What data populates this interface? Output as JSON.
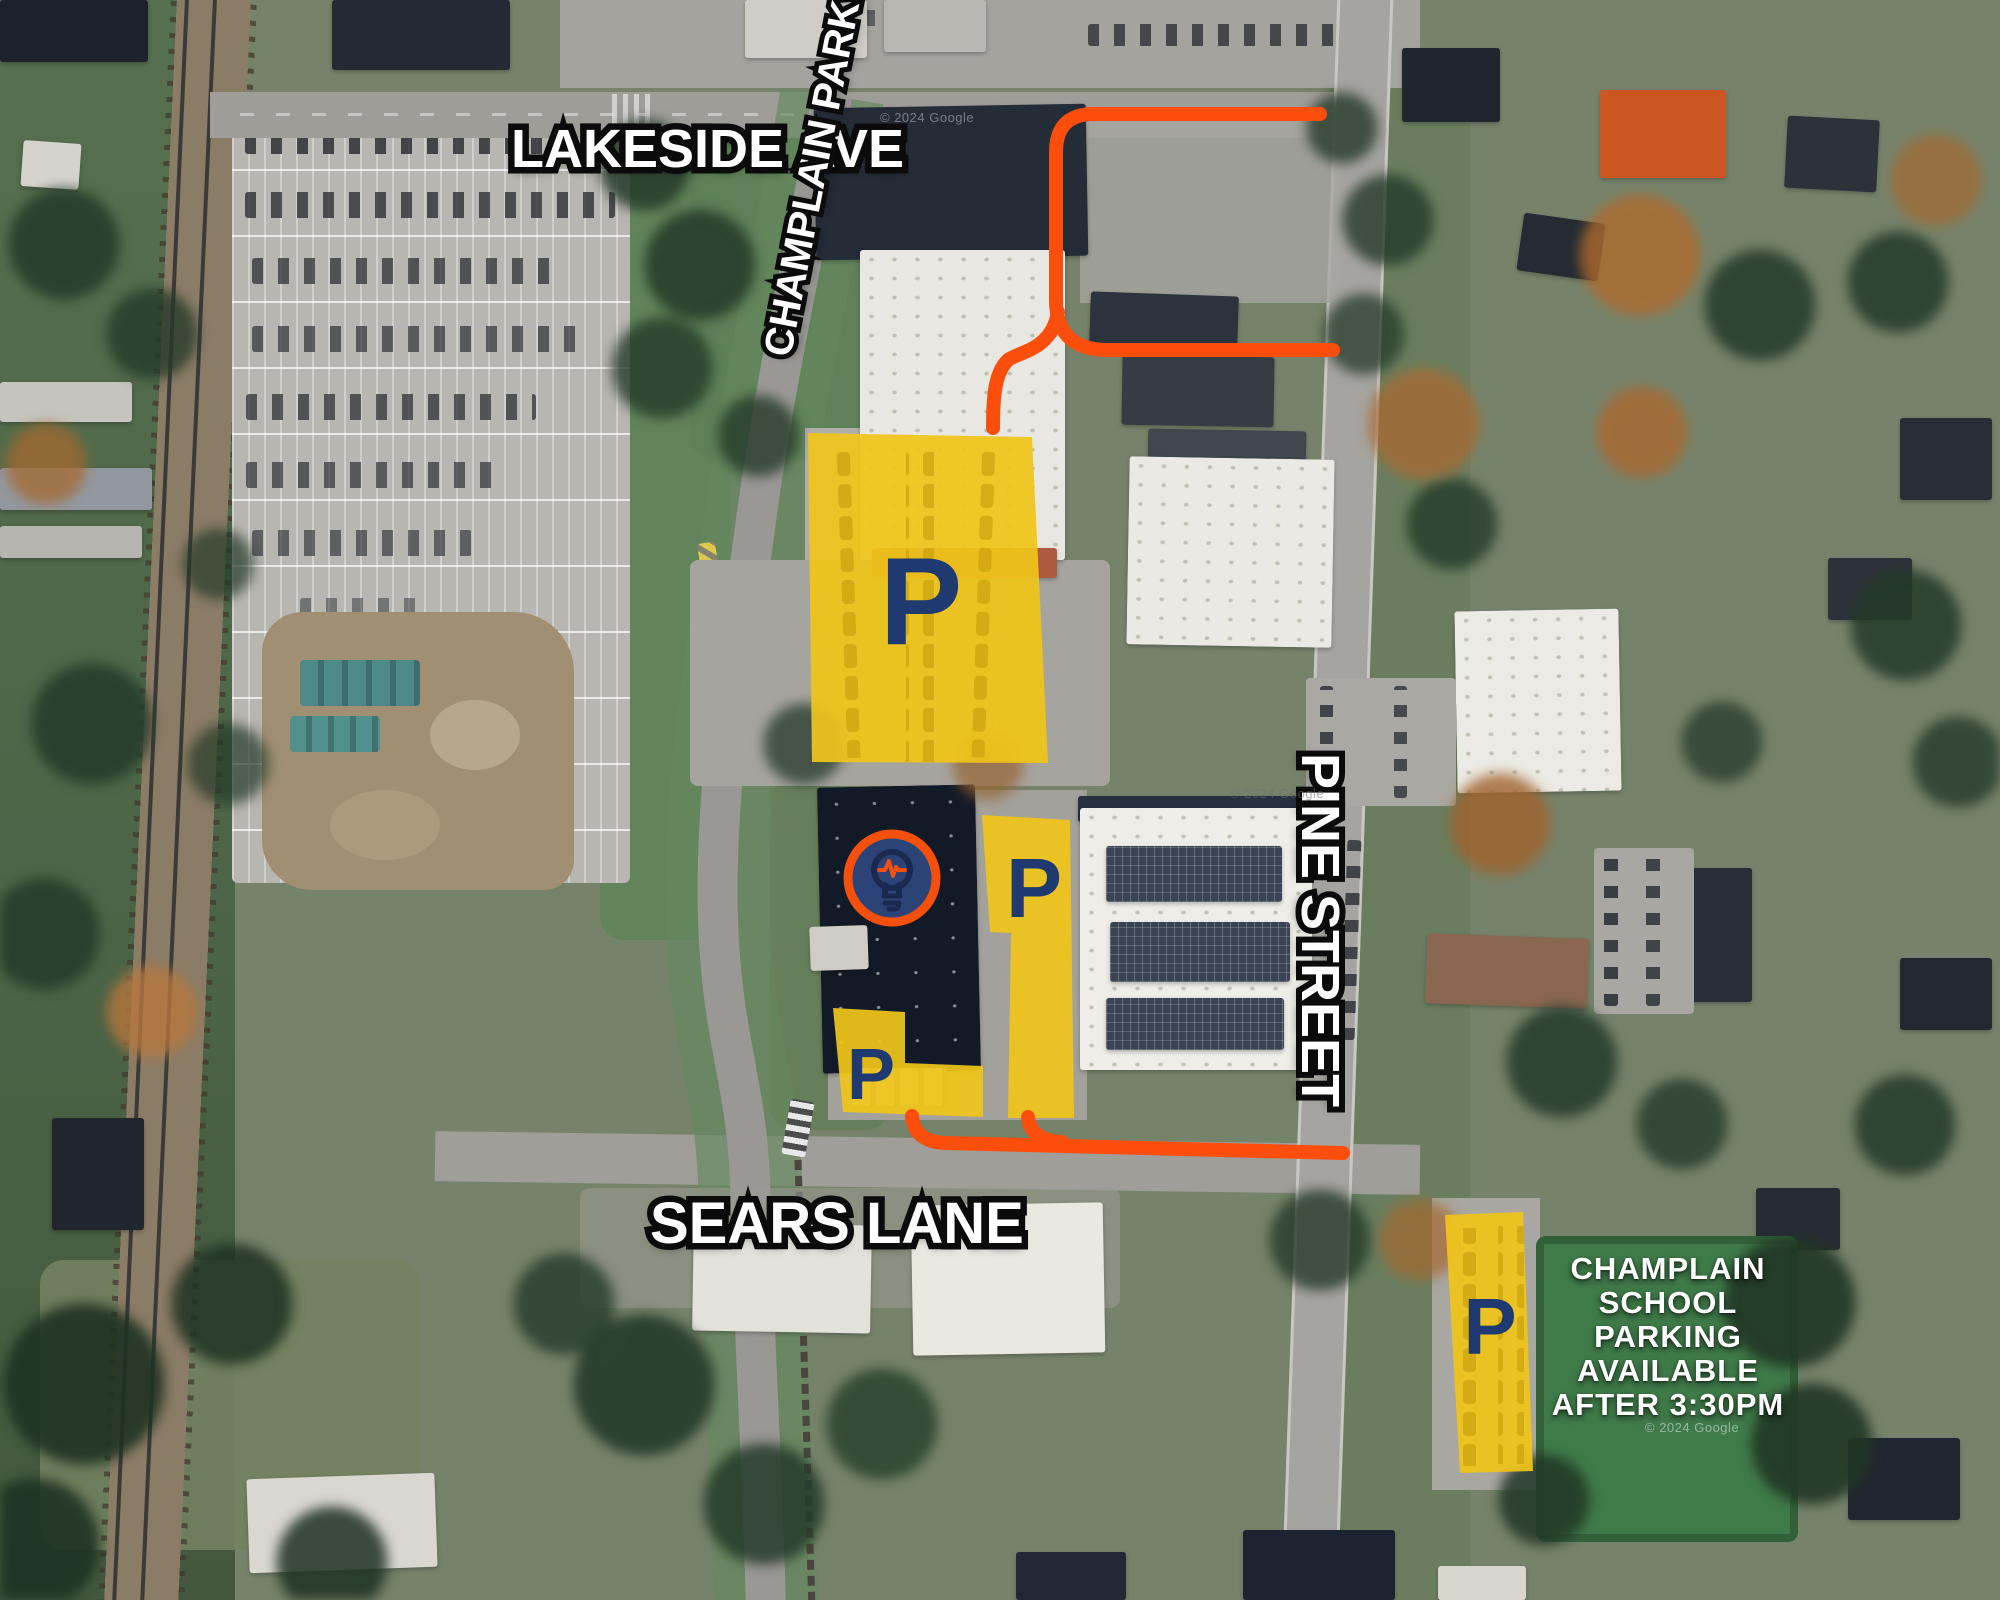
{
  "map": {
    "street_labels": {
      "lakeside": "LAKESIDE AVE",
      "champlain_parkway": "CHAMPLAIN PARKWAY",
      "pine": "PINE STREET",
      "sears": "SEARS LANE"
    },
    "parking": {
      "marker": "P"
    },
    "school_note": {
      "lines": [
        "CHAMPLAIN",
        "SCHOOL",
        "PARKING",
        "AVAILABLE",
        "AFTER 3:30PM"
      ]
    },
    "colors": {
      "parking_zone_fill": "#EFC51A",
      "parking_marker": "#1F3A70",
      "route_line": "#FB4E0D",
      "street_label_fill": "#FFFFFF",
      "street_label_outline": "#0B0B0B",
      "logo_ring": "#F4500C",
      "logo_disc": "#2B4377"
    },
    "logo": {
      "icon": "lightbulb-pulse-icon"
    },
    "watermark": "© 2024 Google"
  }
}
